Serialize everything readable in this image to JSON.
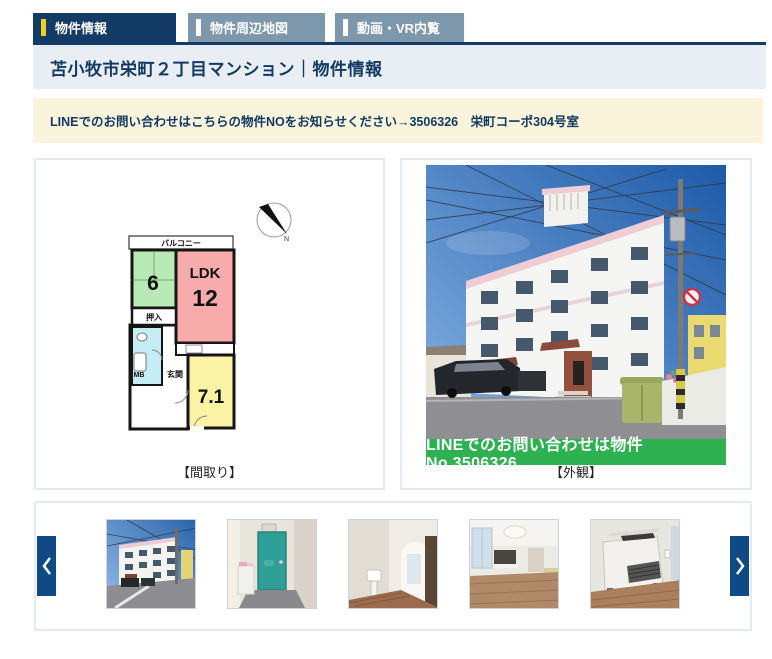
{
  "tabs": [
    {
      "label": "物件情報"
    },
    {
      "label": "物件周辺地図"
    },
    {
      "label": "動画・VR内覧"
    }
  ],
  "header": {
    "title": "苫小牧市栄町２丁目マンション｜物件情報"
  },
  "notice": {
    "text": "LINEでのお問い合わせはこちらの物件NOをお知らせください→3506326　栄町コーポ304号室"
  },
  "floorplan": {
    "caption": "【間取り】",
    "labels": {
      "balcony": "バルコニー",
      "tatami_size": "6",
      "ldk": "LDK",
      "ldk_size": "12",
      "closet": "押入",
      "entrance": "玄関",
      "meter_box": "MB",
      "western_size": "7.1",
      "north": "N"
    }
  },
  "exterior": {
    "caption": "【外観】",
    "banner_text": "LINEでのお問い合わせは物件No.3506326"
  },
  "colors": {
    "active_tab": "#143a66",
    "inactive_tab": "#7d97ad",
    "tab_accent_yellow": "#f0d024",
    "banner_green": "#2eb150",
    "notice_bg": "#fbf4dd",
    "titlebar_bg": "#e9eef5"
  }
}
